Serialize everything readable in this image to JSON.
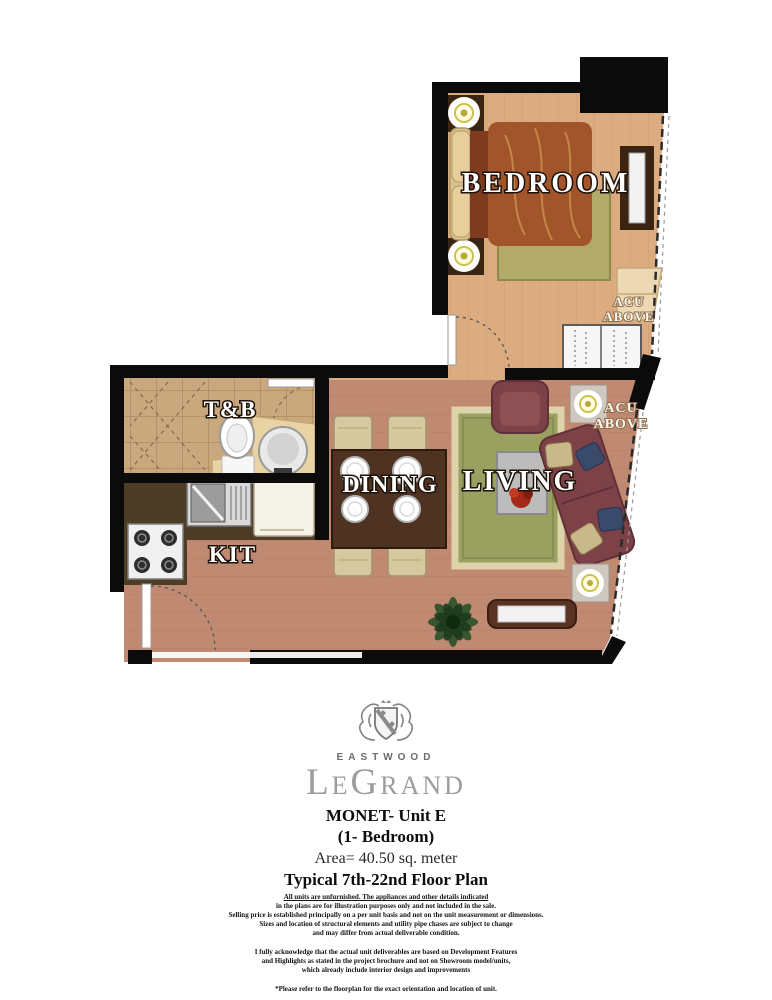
{
  "floor_plan": {
    "labels": {
      "bedroom": "BEDROOM",
      "toilet_bath": "T&B",
      "kitchen": "KIT",
      "dining": "DINING",
      "living": "LIVING",
      "acu": "ACU",
      "above": "ABOVE"
    },
    "colors": {
      "wall": "#0b0b0b",
      "bedroom_floor": "#dcab80",
      "living_floor": "#c08a72",
      "tile_floor": "#c9a87e",
      "kitchen_counter": "#4e3d26",
      "rug_green": "#9aa05f",
      "bed_duvet": "#a2552b",
      "sofa_maroon": "#7c4247",
      "chair_cream": "#d6c9a0",
      "label_text": "#ffffff"
    }
  },
  "branding": {
    "estate": "EASTWOOD",
    "brand": "LeGrand",
    "unit": "MONET- Unit E",
    "type": "(1- Bedroom)",
    "area": "Area= 40.50 sq. meter",
    "floors": "Typical 7th-22nd Floor Plan"
  },
  "disclaimer": {
    "p1": [
      "All units are unfurnished. The appliances and other details indicated",
      "in the plans are for illustration purposes only and not included in the sale.",
      "Selling price is established principally on a per unit basis and not on the unit measurement or dimensions.",
      "Sizes and location of structural elements and utility pipe chases are subject to change",
      "and may differ from actual deliverable condition."
    ],
    "p2": [
      "I fully acknowledge that the actual unit deliverables are based on Development Features",
      "and Highlights as stated in the project brochure and not on Showroom model/units,",
      "which already include interior design and improvements"
    ],
    "p3": "*Please refer to the floorplan for the exact orientation and location of unit."
  }
}
